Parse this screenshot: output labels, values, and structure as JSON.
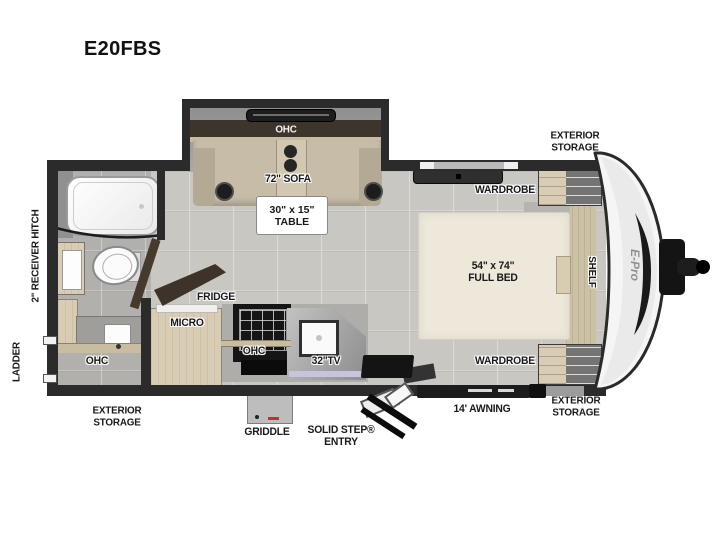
{
  "title": "E20FBS",
  "labels": {
    "ohc_sofa": "OHC",
    "sofa": "72\" SOFA",
    "table_line1": "30\" x 15\"",
    "table_line2": "TABLE",
    "wardrobe_top": "WARDROBE",
    "wardrobe_bottom": "WARDROBE",
    "bed_line1": "54\" x 74\"",
    "bed_line2": "FULL BED",
    "shelf": "SHELF",
    "fridge": "FRIDGE",
    "micro": "MICRO",
    "ohc_kitchen": "OHC",
    "tv": "32\"TV",
    "ohc_bath": "OHC",
    "storage_top_right": "EXTERIOR STORAGE",
    "storage_bottom_left": "EXTERIOR STORAGE",
    "storage_bottom_right": "EXTERIOR STORAGE",
    "awning": "14' AWNING",
    "griddle": "GRIDDLE",
    "entry_line1": "SOLID STEP®",
    "entry_line2": "ENTRY",
    "ladder": "LADDER",
    "receiver_hitch": "2\" RECEIVER HITCH",
    "brand": "E-Pro"
  },
  "colors": {
    "wall": "#2b2b2b",
    "floor": "#c9c7c2",
    "bath_floor": "#b2b0ad",
    "wood": "#d8cdb4",
    "sofa": "#c6bca8",
    "bed": "#eee8db",
    "ohc_band": "#3d342b",
    "lavender_accent": "#c8c4dd",
    "nose_cap": "#f5f5f5",
    "appliance_dark": "#151515"
  }
}
